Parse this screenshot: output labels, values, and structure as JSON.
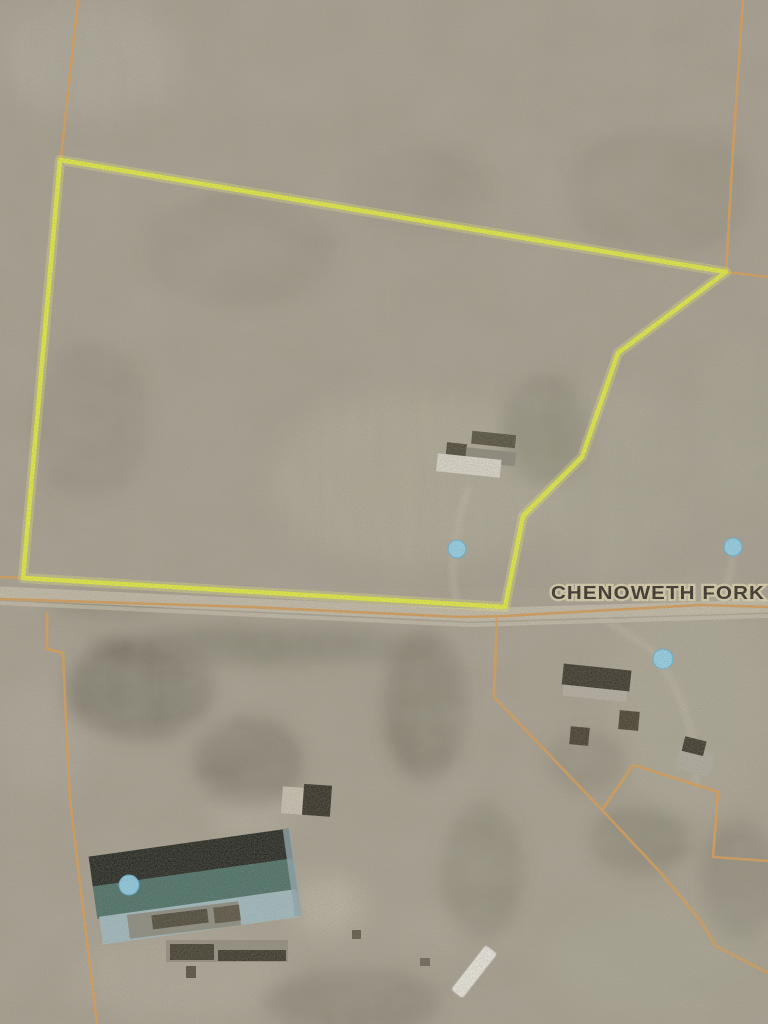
{
  "map": {
    "road_label": "CHENOWETH FORK",
    "colors": {
      "terrain_base": "#a8a090",
      "parcel_outline_yellow": "#e6f03c",
      "parcel_glow": "#f1f870",
      "boundary_orange": "#dd9f54",
      "road_line_orange": "#d79a52",
      "marker_blue_fill": "#92d4ee",
      "marker_blue_edge": "#5fb0d4",
      "label_fill": "#322e25",
      "label_halo": "#d9d0ab",
      "warehouse_roof_dark": "#23261f",
      "warehouse_roof_teal": "#4b7168",
      "warehouse_roof_light": "#a2bcc2"
    },
    "parcel": {
      "points": "60,160 726,272 618,353 582,457 523,516 505,607 23,578"
    },
    "lines": {
      "top_left": "78,0 61,158",
      "top_right": "743,0 733,150 726,272 768,277",
      "road_west": "0,577 23,578",
      "road_edge": "0,599 250,607 460,617 505,616 700,605 768,607",
      "sw_zigzag": "47,612 47,649 63,653 66,722 70,800 97,1024",
      "se_diagonal": "497,618 494,697 602,810 660,872 699,919 716,946 768,973",
      "se_branch": "602,810 633,765 718,792 713,857 768,861"
    },
    "markers": [
      {
        "name": "pond-marker-parcel",
        "cx": "457",
        "cy": "549",
        "r": "9"
      },
      {
        "name": "pond-marker-east",
        "cx": "733",
        "cy": "547",
        "r": "9"
      },
      {
        "name": "pond-marker-southeast",
        "cx": "663",
        "cy": "659",
        "r": "10"
      },
      {
        "name": "pond-marker-warehouse",
        "cx": "129",
        "cy": "885",
        "r": "10"
      }
    ]
  }
}
